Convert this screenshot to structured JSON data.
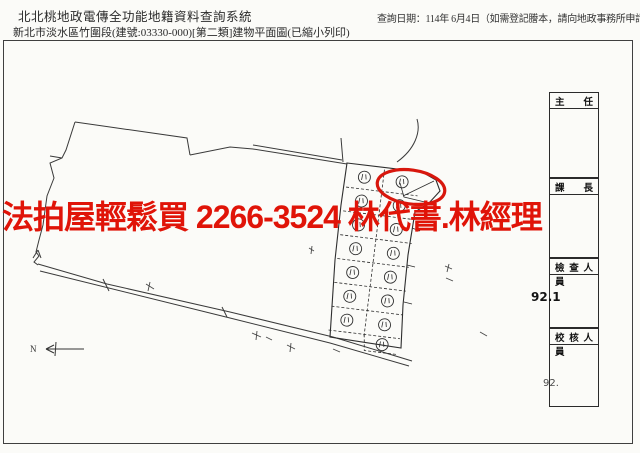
{
  "header": {
    "title": "北北桃地政電傳全功能地籍資料查詢系統",
    "subtitle": "新北市淡水區竹圍段(建號:03330-000)[第二類]建物平面圖(已縮小列印)",
    "query_date": "查詢日期：114年 6月4日（如需登記謄本，請向地政事務所申請。）"
  },
  "watermark": {
    "text": "法拍屋輕鬆買 2266-3524 林代書.林經理",
    "color": "#e01408"
  },
  "signature_boxes": [
    {
      "label": "主 任"
    },
    {
      "label": "課 長"
    },
    {
      "label": "檢 查 人 員"
    },
    {
      "label": "校 核 人 員"
    }
  ],
  "annotations": {
    "number_top": "92.1",
    "number_bottom": "92."
  },
  "map": {
    "north_label": "N",
    "highlight_color": "#d8170d",
    "line_color": "#3a3a3a"
  }
}
